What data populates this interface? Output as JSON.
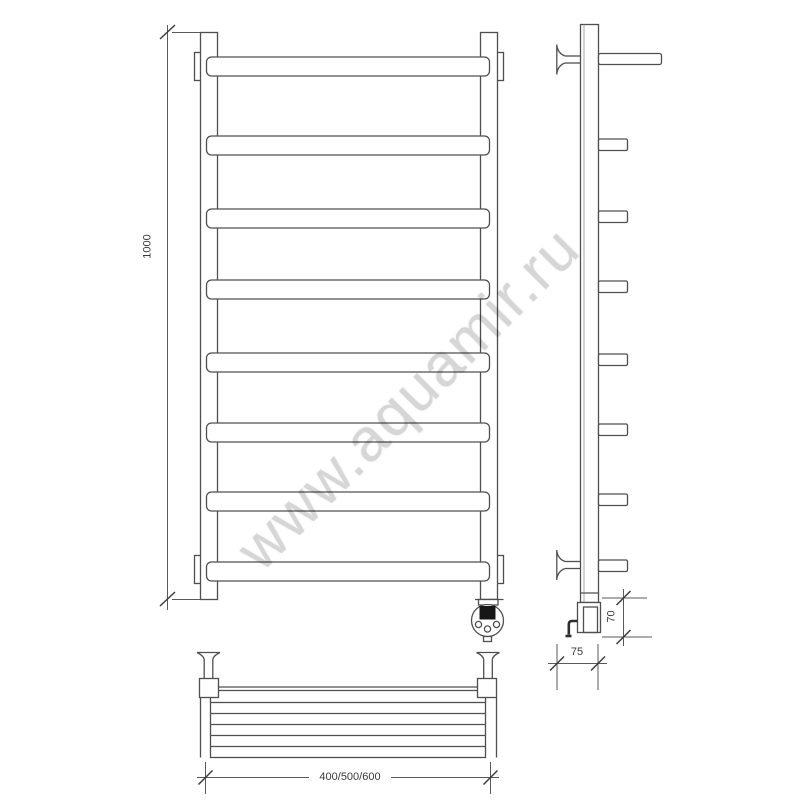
{
  "watermark": {
    "text": "www.aquamir.ru",
    "color": "#d6d6d6"
  },
  "drawing": {
    "type": "technical-drawing",
    "line_color": "#4f4f4f",
    "label_color": "#3a3a3a",
    "front_view": {
      "rung_count": 8
    },
    "side_view": {
      "rung_count": 8
    },
    "dimensions": {
      "height": "1000",
      "element_height": "70",
      "depth": "75",
      "width_options": "400/500/600"
    }
  }
}
